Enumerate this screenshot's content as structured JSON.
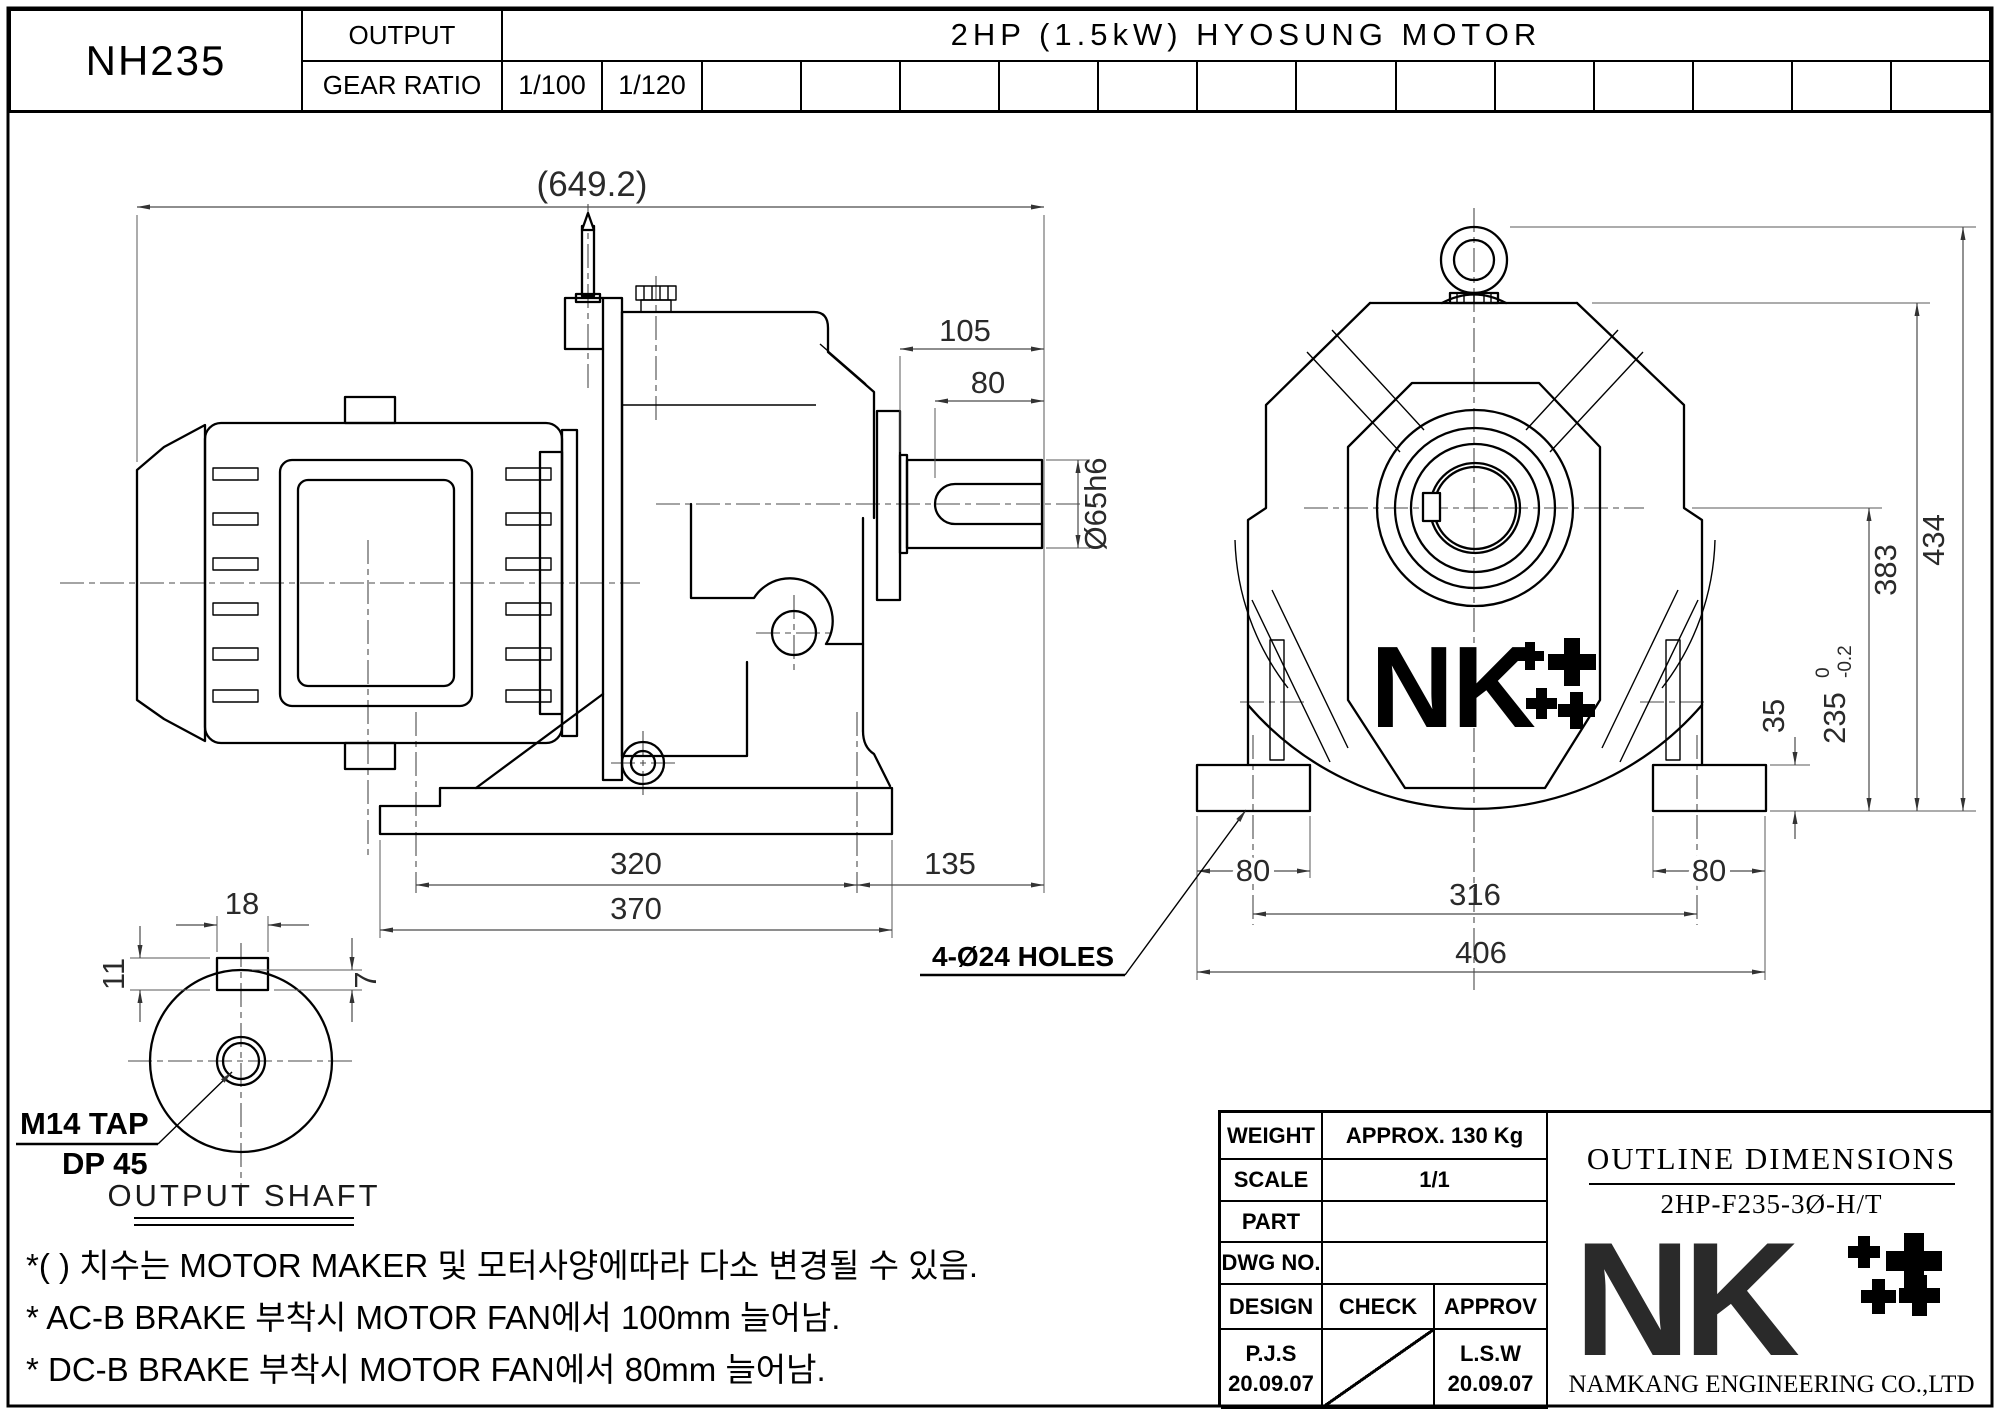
{
  "header": {
    "model": "NH235",
    "output_label": "OUTPUT",
    "gear_ratio_label": "GEAR RATIO",
    "motor": "2HP (1.5kW) HYOSUNG MOTOR",
    "ratio_1": "1/100",
    "ratio_2": "1/120"
  },
  "side_view": {
    "overall_len": "(649.2)",
    "shaft_len": "105",
    "key_len": "80",
    "shaft_dia": "Ø65h6",
    "bolt_pitch": "320",
    "base_len": "370",
    "overhang": "135"
  },
  "front_view": {
    "total_h": "434",
    "body_h": "383",
    "center_h": "235",
    "center_h_tol_up": "0",
    "center_h_tol_low": "-0.2",
    "foot_h": "35",
    "foot_w_left": "80",
    "foot_w_right": "80",
    "hole_pitch": "316",
    "base_w": "406",
    "holes_label": "4-Ø24 HOLES"
  },
  "shaft_detail": {
    "key_w": "18",
    "key_total": "11",
    "key_depth": "7",
    "tap_line1": "M14 TAP",
    "tap_line2": "DP 45",
    "caption": "OUTPUT SHAFT"
  },
  "logo": {
    "nk": "NK"
  },
  "notes": [
    "*( ) 치수는 MOTOR MAKER 및 모터사양에따라 다소 변경될 수 있음.",
    "* AC-B BRAKE 부착시 MOTOR FAN에서 100mm 늘어남.",
    "* DC-B BRAKE 부착시 MOTOR FAN에서 80mm 늘어남."
  ],
  "title_block": {
    "weight_label": "WEIGHT",
    "weight": "APPROX. 130 Kg",
    "scale_label": "SCALE",
    "scale": "1/1",
    "part_label": "PART",
    "part": "",
    "dwg_label": "DWG NO.",
    "dwg": "",
    "design_label": "DESIGN",
    "check_label": "CHECK",
    "approv_label": "APPROV",
    "design_name": "P.J.S",
    "design_date": "20.09.07",
    "approv_name": "L.S.W",
    "approv_date": "20.09.07",
    "doc_title": "OUTLINE DIMENSIONS",
    "doc_model": "2HP-F235-3Ø-H/T",
    "company": "NAMKANG ENGINEERING CO.,LTD"
  }
}
